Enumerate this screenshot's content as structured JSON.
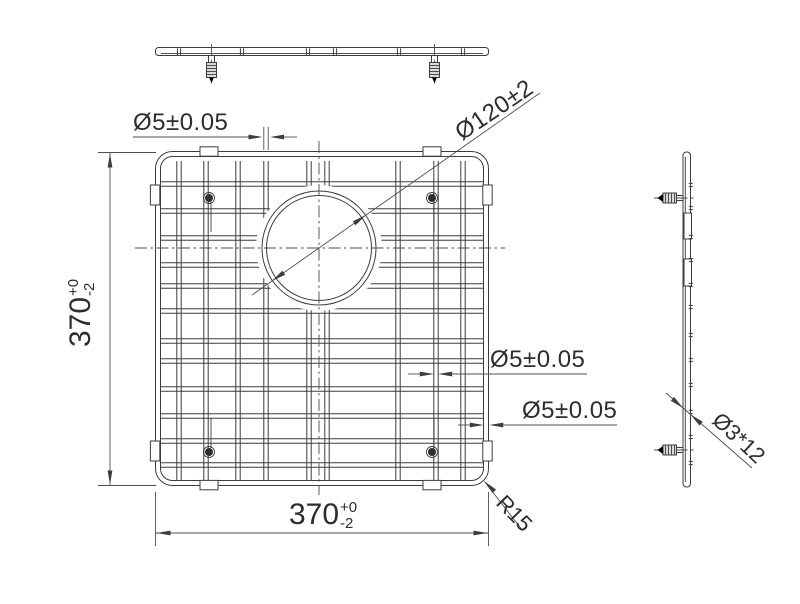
{
  "labels": {
    "wire_dia_top": "Ø5±0.05",
    "wire_dia_mid": "Ø5±0.05",
    "wire_dia_right": "Ø5±0.05",
    "hole_dia": "Ø120±2",
    "corner_radius": "R15",
    "foot_size": "Ø3*12",
    "width_value": "370",
    "width_tol_plus": "+0",
    "width_tol_minus": "-2",
    "height_value": "370",
    "height_tol_plus": "+0",
    "height_tol_minus": "-2"
  },
  "geometry": {
    "main_view": {
      "frame": {
        "x": 155.5,
        "y": 151.5,
        "size": 333,
        "corner_radius": 17
      },
      "vertical_wires_x": [
        179,
        206,
        238,
        266,
        309,
        327,
        398,
        436,
        463
      ],
      "horizontal_wires_y": [
        184,
        211,
        238,
        265,
        286,
        311,
        341,
        361,
        389,
        416,
        441,
        465
      ],
      "hole": {
        "cx": 319,
        "cy": 248,
        "r_outer": 57,
        "r_inner": 52.5
      },
      "feet": [
        [
          209,
          198
        ],
        [
          432,
          198
        ],
        [
          209,
          452
        ],
        [
          432,
          452
        ]
      ],
      "pads_top_bottom_x": [
        200,
        423
      ],
      "pads_left_right_y": [
        185,
        441
      ]
    },
    "top_view": {
      "ticks_x": [
        179,
        242,
        308,
        335,
        399,
        463
      ],
      "feet_x": [
        211.5,
        434.5
      ]
    },
    "side_view": {
      "ticks_y": [
        185,
        208,
        237,
        260,
        285,
        307,
        335,
        360,
        385,
        412,
        437,
        463
      ],
      "feet_y": [
        198,
        450
      ],
      "slots_y": [
        213,
        259
      ]
    }
  },
  "colors": {
    "line": "#3d3d3d",
    "dimension": "#4f4f4f",
    "text": "#2d2d2d",
    "background": "#ffffff"
  }
}
